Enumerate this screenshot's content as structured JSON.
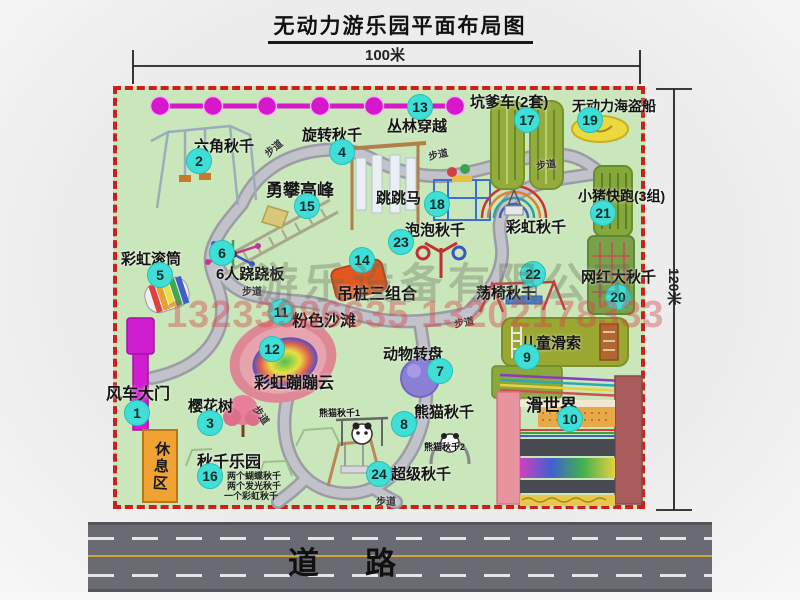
{
  "title": "无动力游乐园平面布局图",
  "dim_width": "100米",
  "dim_height": "120米",
  "road_label": "道路",
  "path_label": "步道",
  "rest_area": {
    "label": "休息区"
  },
  "watermark": {
    "company": "游乐设备有限公司",
    "phone": "13233986635 13202178333"
  },
  "extra_labels": {
    "rainbow_swing": "彩虹秋千",
    "panda_swing_1": "熊猫秋千1",
    "panda_swing_2": "熊猫秋千2"
  },
  "attractions": [
    {
      "num": "1",
      "label": "风车大门"
    },
    {
      "num": "2",
      "label": "六角秋千"
    },
    {
      "num": "3",
      "label": "樱花树"
    },
    {
      "num": "4",
      "label": "旋转秋千"
    },
    {
      "num": "5",
      "label": "彩虹滚筒"
    },
    {
      "num": "6",
      "label": "6人跷跷板"
    },
    {
      "num": "7",
      "label": "动物转盘"
    },
    {
      "num": "8",
      "label": "熊猫秋千"
    },
    {
      "num": "9",
      "label": "儿童滑索"
    },
    {
      "num": "10",
      "label": "滑世界"
    },
    {
      "num": "11",
      "label": "粉色沙滩"
    },
    {
      "num": "12",
      "label": "彩虹蹦蹦云"
    },
    {
      "num": "13",
      "label": "丛林穿越"
    },
    {
      "num": "14",
      "label": "吊桩三组合"
    },
    {
      "num": "15",
      "label": "勇攀高峰"
    },
    {
      "num": "16",
      "label": "秋千乐园",
      "sub": [
        "两个蝴蝶秋千",
        "两个发光秋千",
        "一个彩虹秋千"
      ]
    },
    {
      "num": "17",
      "label": "坑爹车(2套)"
    },
    {
      "num": "18",
      "label": "跳跳马"
    },
    {
      "num": "19",
      "label": "无动力海盗船"
    },
    {
      "num": "20",
      "label": "网红大秋千"
    },
    {
      "num": "21",
      "label": "小猪快跑(3组)"
    },
    {
      "num": "22",
      "label": "荡椅秋千"
    },
    {
      "num": "23",
      "label": "泡泡秋千"
    },
    {
      "num": "24",
      "label": "超级秋千"
    }
  ],
  "colors": {
    "park_green": "#cae6bb",
    "border_red": "#cc2020",
    "badge_cyan": "#3fded6",
    "road_gray": "#6a6a72",
    "magenta": "#d617cc",
    "rest_orange": "#f0a232"
  }
}
